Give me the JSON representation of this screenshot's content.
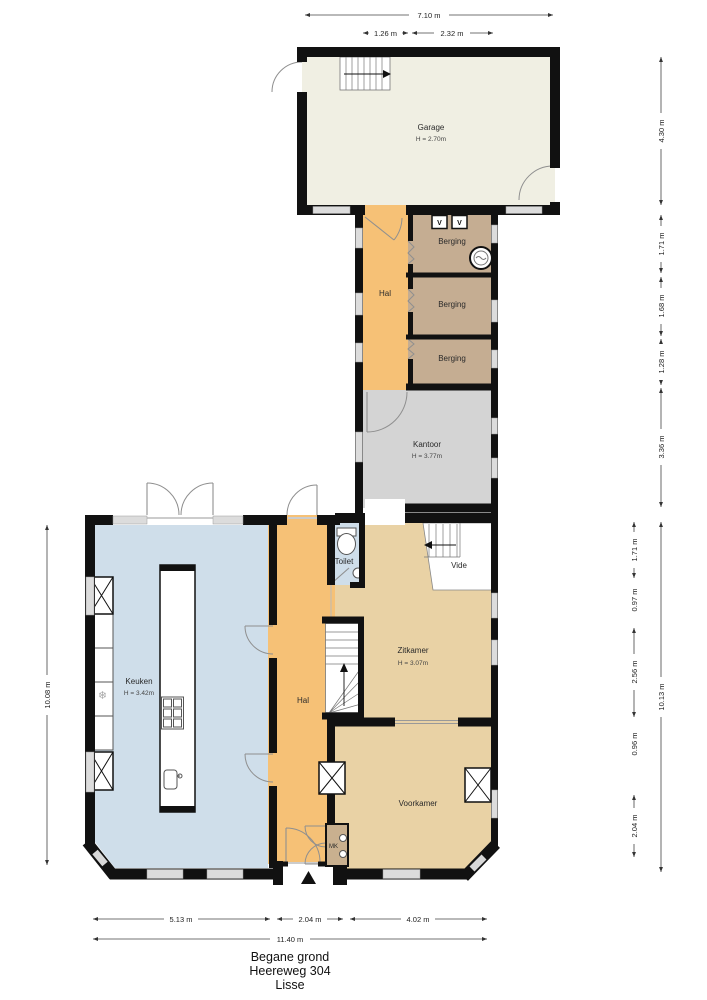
{
  "title": {
    "level": "Begane grond",
    "street": "Heereweg 304",
    "city": "Lisse"
  },
  "rooms": {
    "garage": {
      "name": "Garage",
      "height": "H = 2.70m"
    },
    "hal_top": {
      "name": "Hal"
    },
    "berging_1": {
      "name": "Berging"
    },
    "berging_2": {
      "name": "Berging"
    },
    "berging_3": {
      "name": "Berging"
    },
    "kantoor": {
      "name": "Kantoor",
      "height": "H = 3.77m"
    },
    "keuken": {
      "name": "Keuken",
      "height": "H = 3.42m"
    },
    "hal_main": {
      "name": "Hal"
    },
    "toilet": {
      "name": "Toilet"
    },
    "vide": {
      "name": "Vide"
    },
    "zitkamer": {
      "name": "Zitkamer",
      "height": "H = 3.07m"
    },
    "voorkamer": {
      "name": "Voorkamer"
    },
    "meterkast": {
      "name": "MK"
    }
  },
  "dimensions": {
    "top_total": "7.10 m",
    "top_hal": "1.26 m",
    "top_berging": "2.32 m",
    "right_garage": "4.30 m",
    "right_berging1": "1.71 m",
    "right_berging2": "1.68 m",
    "right_berging3": "1.28 m",
    "right_kantoor": "3.36 m",
    "right_zit_a": "1.71 m",
    "right_zit_b": "0.97 m",
    "right_zit_c": "2.56 m",
    "right_voor_a": "0.96 m",
    "right_voor_b": "2.04 m",
    "right_total_lower": "10.13 m",
    "left_total": "10.08 m",
    "bottom_keuken": "5.13 m",
    "bottom_hal": "2.04 m",
    "bottom_voorkamer": "4.02 m",
    "bottom_total": "11.40 m"
  },
  "icons": {
    "ventilation_label": "V",
    "fridge_glyph": "❄"
  },
  "colors": {
    "wall": "#111111",
    "garage_floor": "#f0efe3",
    "hal_floor": "#f6c176",
    "berging_floor": "#c5ad92",
    "kantoor_floor": "#d4d4d4",
    "keuken_floor": "#cfdeea",
    "toilet_floor": "#cfdeea",
    "zitkamer_floor": "#e9d2a5",
    "meterkast_floor": "#c9b08f",
    "vide_floor": "#ffffff",
    "window": "#dcdcdc"
  }
}
